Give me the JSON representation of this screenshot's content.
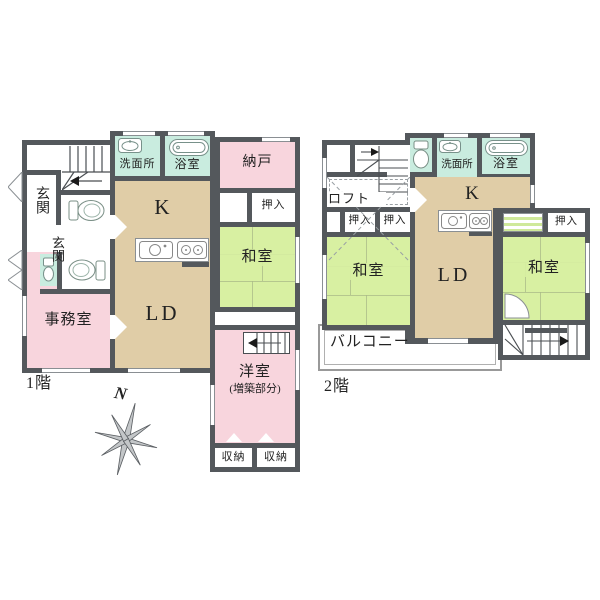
{
  "colors": {
    "wall": "#54585c",
    "room_pink": "#f8d5dd",
    "room_tan": "#e0cda7",
    "room_green": "#d8f0a2",
    "room_teal": "#c9ecdf"
  },
  "floor1": {
    "label": "1階",
    "genkan_upper": "玄関",
    "genkan_lower": "玄関",
    "senmenjo": "洗面所",
    "yokushitsu": "浴室",
    "nando": "納戸",
    "kitchen": "K",
    "oshiire": "押入",
    "washitsu": "和室",
    "jimushitsu": "事務室",
    "ld": "LD",
    "youshitsu": "洋室",
    "youshitsu_note": "(増築部分)",
    "shuno_left": "収納",
    "shuno_right": "収納"
  },
  "floor2": {
    "label": "2階",
    "loft": "ロフト",
    "senmenjo": "洗面所",
    "yokushitsu": "浴室",
    "kitchen": "K",
    "oshiire_a": "押入",
    "oshiire_b": "押入",
    "oshiire_right": "押入",
    "washitsu_left": "和室",
    "washitsu_right": "和室",
    "ld": "LD",
    "balcony": "バルコニー"
  },
  "compass": {
    "north": "N"
  }
}
